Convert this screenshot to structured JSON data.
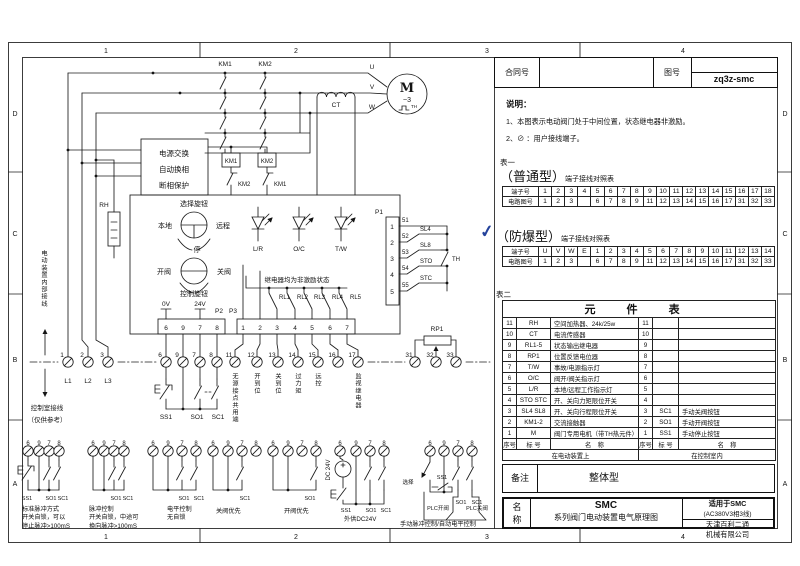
{
  "frame": {
    "cols": [
      "1",
      "2",
      "3",
      "4"
    ],
    "rows": [
      "D",
      "C",
      "B",
      "A"
    ]
  },
  "title_block": {
    "contract_label": "合同号",
    "drawing_label": "图号",
    "drawing_no": "zq3z-smc"
  },
  "notes": {
    "heading": "说明：",
    "item1": "1、本图表示电动阀门处于中间位置，状态继电器非激励。",
    "item2": "2、⊘ ：用户接线端子。"
  },
  "table1": {
    "caption": "表一",
    "type": "（普通型）",
    "subtitle": "端子接线对照表",
    "row1_label": "端子号",
    "row2_label": "电路图号",
    "row1": [
      "1",
      "2",
      "3",
      "4",
      "5",
      "6",
      "7",
      "8",
      "9",
      "10",
      "11",
      "12",
      "13",
      "14",
      "15",
      "16",
      "17",
      "18"
    ],
    "row2": [
      "1",
      "2",
      "3",
      "",
      "6",
      "7",
      "8",
      "9",
      "11",
      "12",
      "13",
      "14",
      "15",
      "16",
      "17",
      "31",
      "32",
      "33"
    ]
  },
  "table2": {
    "check": "✓",
    "type": "（防爆型）",
    "subtitle": "端子接线对照表",
    "row1_label": "端子号",
    "row2_label": "电路图号",
    "row1": [
      "U",
      "V",
      "W",
      "E",
      "1",
      "2",
      "3",
      "4",
      "5",
      "6",
      "7",
      "8",
      "9",
      "10",
      "11",
      "12",
      "13",
      "14"
    ],
    "row2": [
      "1",
      "2",
      "3",
      "",
      "6",
      "7",
      "8",
      "9",
      "11",
      "12",
      "13",
      "14",
      "15",
      "16",
      "17",
      "31",
      "32",
      "33"
    ]
  },
  "parts": {
    "caption": "表二",
    "title": "元 件 表",
    "rows": [
      {
        "ln": "11",
        "lc": "RH",
        "lm": "空间加热器、24k/25w",
        "rn": "11",
        "rc": "",
        "rm": ""
      },
      {
        "ln": "10",
        "lc": "CT",
        "lm": "电流传感器",
        "rn": "10",
        "rc": "",
        "rm": ""
      },
      {
        "ln": "9",
        "lc": "RL1-5",
        "lm": "状态输出继电器",
        "rn": "9",
        "rc": "",
        "rm": ""
      },
      {
        "ln": "8",
        "lc": "RP1",
        "lm": "位置反馈电位器",
        "rn": "8",
        "rc": "",
        "rm": ""
      },
      {
        "ln": "7",
        "lc": "T/W",
        "lm": "事故/电源指示灯",
        "rn": "7",
        "rc": "",
        "rm": ""
      },
      {
        "ln": "6",
        "lc": "O/C",
        "lm": "阀开/阀关指示灯",
        "rn": "6",
        "rc": "",
        "rm": ""
      },
      {
        "ln": "5",
        "lc": "L/R",
        "lm": "本地/远程工作指示灯",
        "rn": "5",
        "rc": "",
        "rm": ""
      },
      {
        "ln": "4",
        "lc": "STO STC",
        "lm": "开、关向力矩限位开关",
        "rn": "4",
        "rc": "",
        "rm": ""
      },
      {
        "ln": "3",
        "lc": "SL4 SL8",
        "lm": "开、关向行程限位开关",
        "rn": "3",
        "rc": "SC1",
        "rm": "手动关阀按钮"
      },
      {
        "ln": "2",
        "lc": "KM1-2",
        "lm": "交流接触器",
        "rn": "2",
        "rc": "SO1",
        "rm": "手动开阀按钮"
      },
      {
        "ln": "1",
        "lc": "M",
        "lm": "阀门专用电机（带TH热元件）",
        "rn": "1",
        "rc": "SS1",
        "rm": "手动停止按钮"
      }
    ],
    "foot": [
      "序号",
      "标 号",
      "名　称",
      "序号",
      "标 号",
      "名　称"
    ],
    "loc_left": "在电动装置上",
    "loc_right": "在控制室内"
  },
  "remark": {
    "label": "备注",
    "value": "整体型"
  },
  "name_block": {
    "label1": "名",
    "label2": "称",
    "line1": "SMC",
    "line2": "系列阀门电动装置电气原理图",
    "right1": "适用于SMC",
    "right2": "(AC380V3相3线)",
    "right3": "天津百利二通",
    "right4": "机械有限公司"
  },
  "sch": {
    "km1": "KM1",
    "km2": "KM2",
    "u": "U",
    "v": "V",
    "w": "W",
    "m": "M",
    "m3": "~3",
    "th": "TH",
    "ct": "CT",
    "rh": "RH",
    "power_box": [
      "电源交换",
      "自动换相",
      "断相保护"
    ],
    "km1_coil": "KM1",
    "km2_coil": "KM2",
    "km2_nc": "KM2",
    "km1_nc": "KM1",
    "sel_title": "选择旋钮",
    "local": "本地",
    "remote": "远程",
    "stop": "停",
    "open": "开阀",
    "close": "关阀",
    "ctrl_title": "控制旋钮",
    "leds": [
      "L/R",
      "O/C",
      "T/W"
    ],
    "relay_note": "继电器均为非激励状态",
    "relays": [
      "RL1",
      "RL2",
      "RL3",
      "RL4",
      "RL5"
    ],
    "p1": "P1",
    "p2": "P2",
    "p3": "P3",
    "v0": "0V",
    "v24": "24V",
    "p1_pins": [
      "1",
      "2",
      "3",
      "4",
      "5"
    ],
    "wire_nos": [
      "51",
      "52",
      "53",
      "54",
      "55"
    ],
    "limit_sw": [
      "SL4",
      "SL8",
      "STO",
      "STC"
    ],
    "th2": "TH",
    "p2_pins": [
      "6",
      "9",
      "7",
      "8"
    ],
    "p3_pins": [
      "1",
      "2",
      "3",
      "4",
      "5",
      "6",
      "7"
    ],
    "rp1": "RP1",
    "t_power": [
      "1",
      "2",
      "3"
    ],
    "phases": [
      "L1",
      "L2",
      "L3"
    ],
    "t_ctrl": [
      "6",
      "9",
      "7",
      "8"
    ],
    "t_sig": [
      "11",
      "12",
      "13",
      "14",
      "15",
      "16",
      "17"
    ],
    "sig_labels": [
      "无源接点共用端",
      "开到位",
      "关到位",
      "过力矩",
      "远控",
      "监视继电器"
    ],
    "t_fb": [
      "31",
      "32",
      "33"
    ],
    "ss1": "SS1",
    "so1": "SO1",
    "sc1": "SC1",
    "internal_note": "电动装置内部接线",
    "external_note": "控制室接线",
    "external_note2": "（仅供参考）",
    "dc": "DC 24V",
    "sel2": "选择",
    "plc_open": "PLC开阀",
    "plc_close": "PLC关阀",
    "ex": [
      {
        "t": [
          "6",
          "9",
          "7",
          "8"
        ],
        "b1": "SS1",
        "b2": "SO1",
        "b3": "SC1",
        "cap": [
          "标准脉冲方式",
          "开关自锁，可以",
          "停止脉冲>100mS"
        ]
      },
      {
        "t": [
          "6",
          "9",
          "7",
          "8"
        ],
        "b2": "SO1",
        "b3": "SC1",
        "cap": [
          "脉冲控制",
          "开关自锁，中途可",
          "换向脉冲>100mS"
        ]
      },
      {
        "t": [
          "6",
          "9",
          "7",
          "8"
        ],
        "b2": "SO1",
        "b3": "SC1",
        "cap": [
          "电平控制",
          "无自锁"
        ]
      },
      {
        "t": [
          "6",
          "9",
          "7",
          "8"
        ],
        "b3": "SC1",
        "cap": [
          "关阀优先"
        ]
      },
      {
        "t": [
          "6",
          "9",
          "7",
          "8"
        ],
        "b2": "SO1",
        "cap": [
          "开阀优先"
        ]
      },
      {
        "t": [
          "6",
          "9",
          "7",
          "8"
        ],
        "b1": "SS1",
        "b2": "SO1",
        "b3": "SC1",
        "cap": [
          "外供DC24V"
        ]
      },
      {
        "t": [
          "6",
          "9",
          "7",
          "8"
        ],
        "cap": [
          "手动脉冲控制/自动电平控制"
        ]
      }
    ]
  }
}
